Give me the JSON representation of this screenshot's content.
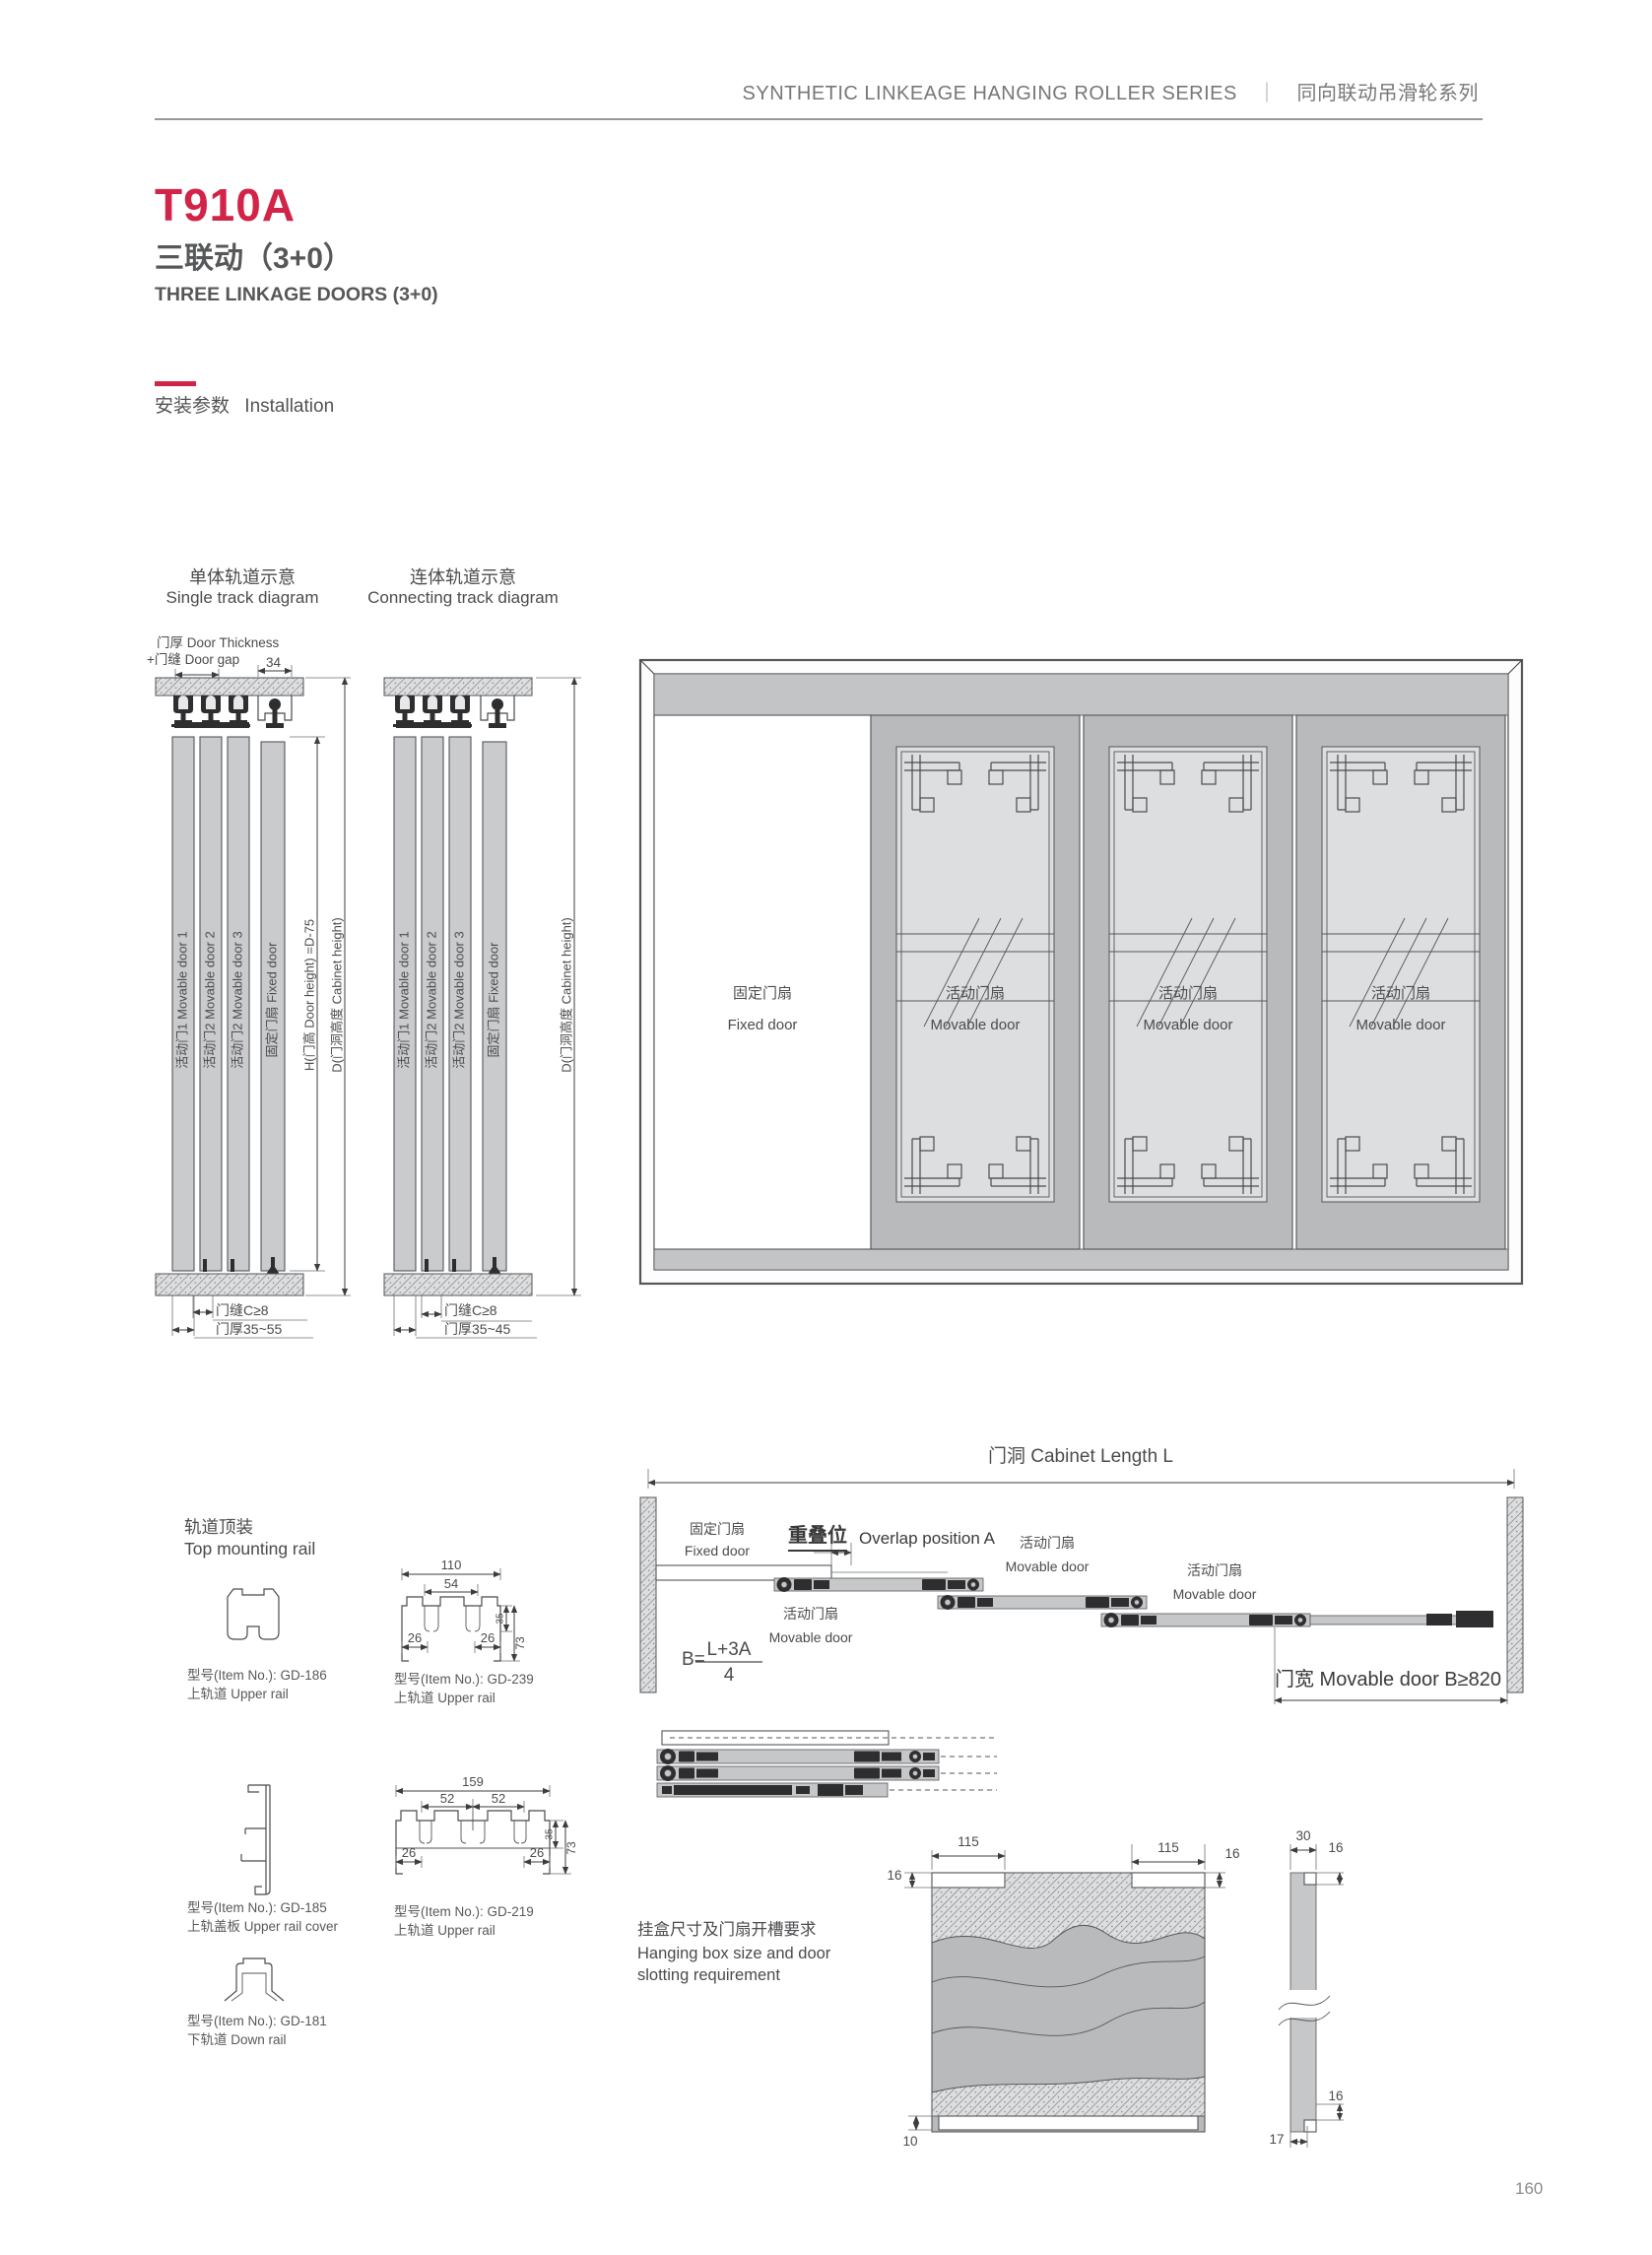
{
  "theme": {
    "accent": "#d22349"
  },
  "header": {
    "series_en": "SYNTHETIC LINKEAGE HANGING ROLLER SERIES",
    "separator": "｜",
    "series_cn": "同向联动吊滑轮系列"
  },
  "product": {
    "model": "T910A",
    "type_cn": "三联动（3+0）",
    "type_en": "THREE LINKAGE DOORS (3+0)"
  },
  "section": {
    "label_cn": "安装参数",
    "label_en": "Installation"
  },
  "single": {
    "title_cn": "单体轨道示意",
    "title_en": "Single track diagram",
    "note1": "门厚 Door Thickness",
    "note2": "+门缝 Door gap",
    "dim34": "34",
    "door1": "活动门1 Movable door 1",
    "door2": "活动门2 Movable door 2",
    "door3": "活动门2 Movable door 3",
    "door4": "固定门扇 Fixed door",
    "dimH": "H(门高 Door height) =D-75",
    "dimD": "D(门洞高度 Cabinet height)",
    "gap": "门缝C≥8",
    "thick": "门厚35~55"
  },
  "connecting": {
    "title_cn": "连体轨道示意",
    "title_en": "Connecting track diagram",
    "door1": "活动门1 Movable door 1",
    "door2": "活动门2 Movable door 2",
    "door3": "活动门2 Movable door 3",
    "door4": "固定门扇 Fixed door",
    "dimD": "D(门洞高度 Cabinet height)",
    "gap": "门缝C≥8",
    "thick": "门厚35~45"
  },
  "cabinet": {
    "fixed_cn": "固定门扇",
    "fixed_en": "Fixed door",
    "movable_cn": "活动门扇",
    "movable_en": "Movable door"
  },
  "rails": {
    "title_cn": "轨道顶装",
    "title_en": "Top mounting rail",
    "gd186": {
      "item": "型号(Item No.): GD-186",
      "name": "上轨道 Upper rail"
    },
    "gd239": {
      "item": "型号(Item No.): GD-239",
      "name": "上轨道 Upper rail",
      "d110": "110",
      "d54": "54",
      "d26a": "26",
      "d26b": "26",
      "d35": "35",
      "d73": "73"
    },
    "gd185": {
      "item": "型号(Item No.): GD-185",
      "name": "上轨盖板 Upper rail cover"
    },
    "gd219": {
      "item": "型号(Item No.): GD-219",
      "name": "上轨道 Upper rail",
      "d159": "159",
      "d52a": "52",
      "d52b": "52",
      "d26a": "26",
      "d26b": "26",
      "d35": "35",
      "d73": "73"
    },
    "gd181": {
      "item": "型号(Item No.): GD-181",
      "name": "下轨道 Down rail"
    }
  },
  "length": {
    "title": "门洞 Cabinet Length L",
    "fixed_cn": "固定门扇",
    "fixed_en": "Fixed door",
    "overlap_cn": "重叠位",
    "overlap_en": "Overlap position A",
    "movable_cn": "活动门扇",
    "movable_en": "Movable door",
    "formula_b": "B=",
    "formula_num": "L+3A",
    "formula_den": "4",
    "width_note": "门宽 Movable door B≥820"
  },
  "hangbox": {
    "note_cn": "挂盒尺寸及门扇开槽要求",
    "note_en1": "Hanging box size and door",
    "note_en2": "slotting requirement",
    "d115a": "115",
    "d16a": "16",
    "d115b": "115",
    "d16b": "16",
    "d10": "10",
    "d30": "30",
    "d16c": "16",
    "d16d": "16",
    "d17": "17"
  },
  "page": {
    "number": "160"
  }
}
